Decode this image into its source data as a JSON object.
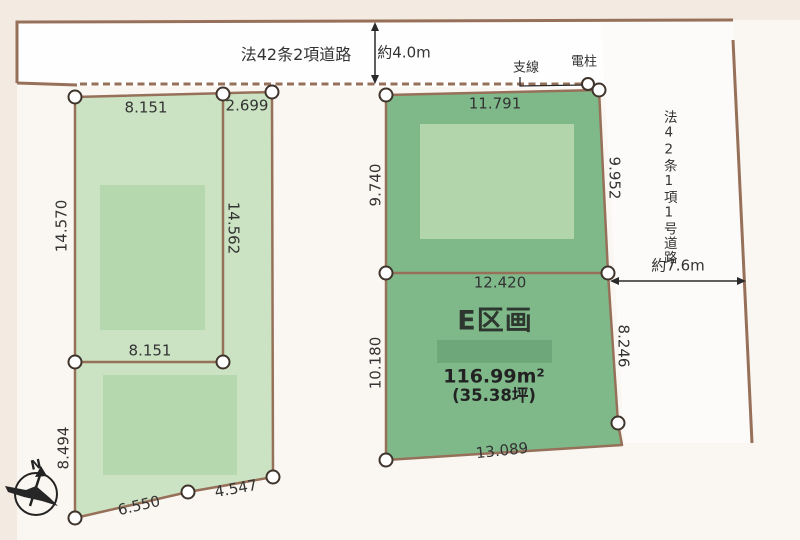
{
  "roads": {
    "top": {
      "label": "法42条2項道路",
      "width_label": "約4.0m"
    },
    "right": {
      "label": "法42条1項1号道路",
      "width_label": "約7.6m"
    }
  },
  "utility": {
    "branch_wire_label": "支線",
    "utility_pole_label": "電柱"
  },
  "compass": {
    "north_label": "N"
  },
  "parcel_left": {
    "dims": {
      "top": "8.151",
      "top_right": "2.699",
      "left_upper": "14.570",
      "middle": "14.562",
      "inner_bottom": "8.151",
      "left_lower": "8.494",
      "bottom_left": "6.550",
      "bottom_right": "4.547"
    }
  },
  "parcel_e": {
    "title": "E区画",
    "area_sqm": "116.99m²",
    "area_tsubo": "(35.38坪)",
    "dims": {
      "top": "11.791",
      "left_upper": "9.740",
      "right_upper": "9.952",
      "middle": "12.420",
      "left_lower": "10.180",
      "right_lower": "8.246",
      "bottom": "13.089"
    }
  },
  "colors": {
    "background": "#faf7f2",
    "margin_tint": "#f3eae1",
    "road_fill": "#fefefe",
    "parcel_left_fill": "#cbe3c3",
    "parcel_e_fill": "#7fb98a",
    "building_left_fill": "#b6d8ae",
    "building_e_fill": "#b2d5ab",
    "redacted_band_fill": "#6da77a",
    "boundary_line": "#97705a",
    "annotation_line": "#2a2a2a",
    "text": "#333333"
  }
}
